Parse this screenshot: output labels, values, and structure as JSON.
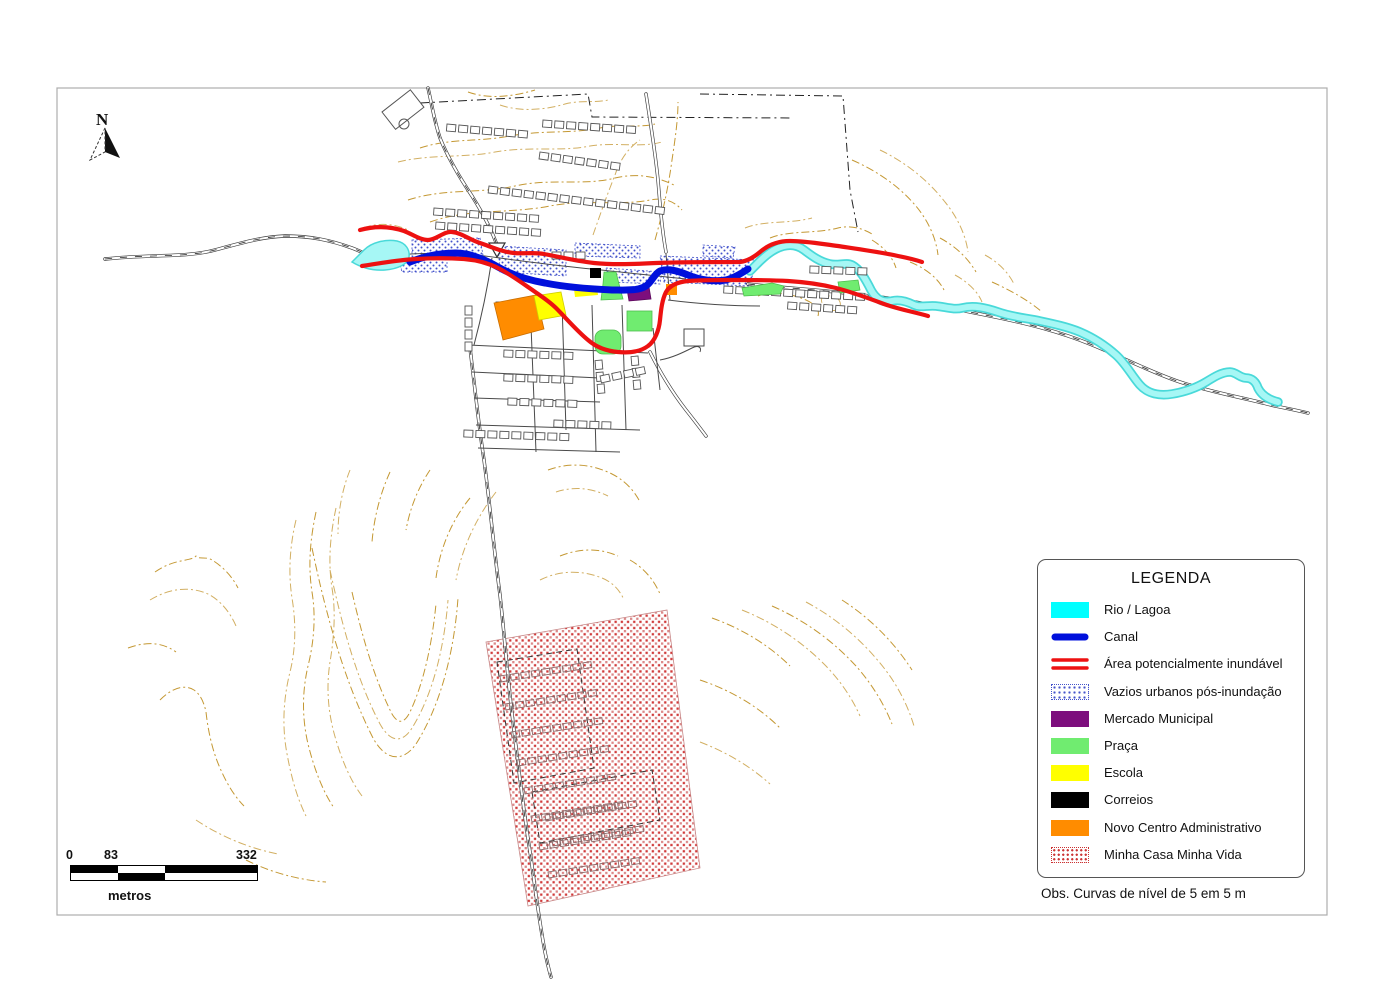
{
  "map": {
    "north": {
      "label": "N"
    },
    "scale_bar": {
      "labels": [
        "0",
        "83",
        "332"
      ],
      "unit": "metros"
    },
    "legend": {
      "title": "LEGENDA",
      "items": [
        {
          "label": "Rio / Lagoa",
          "color": "#00FFFF",
          "swatch": "fill"
        },
        {
          "label": "Canal",
          "color": "#0010DC",
          "swatch": "thick-line"
        },
        {
          "label": "Área potencialmente inundável",
          "color": "#ED1111",
          "swatch": "double-line"
        },
        {
          "label": "Vazios urbanos pós-inundação",
          "color": "#4353CB",
          "swatch": "dot-pattern"
        },
        {
          "label": "Mercado Municipal",
          "color": "#7D0E7D",
          "swatch": "fill"
        },
        {
          "label": "Praça",
          "color": "#70EC70",
          "swatch": "fill"
        },
        {
          "label": "Escola",
          "color": "#FFFF00",
          "swatch": "fill"
        },
        {
          "label": "Correios",
          "color": "#000000",
          "swatch": "fill"
        },
        {
          "label": "Novo Centro Administrativo",
          "color": "#FF8C00",
          "swatch": "fill"
        },
        {
          "label": "Minha Casa Minha Vida",
          "color": "#CC3333",
          "swatch": "dot-pattern"
        }
      ]
    },
    "note": "Obs. Curvas de nível de 5 em 5 m",
    "colors": {
      "contour": "#C49833",
      "flood_line": "#ED1111",
      "canal": "#0010DC",
      "river_fill": "#A6F7F5",
      "river_edge": "#49D9D9",
      "road": "#3a3a3a",
      "building_outline": "#555555",
      "frame": "#ADADAD"
    }
  }
}
